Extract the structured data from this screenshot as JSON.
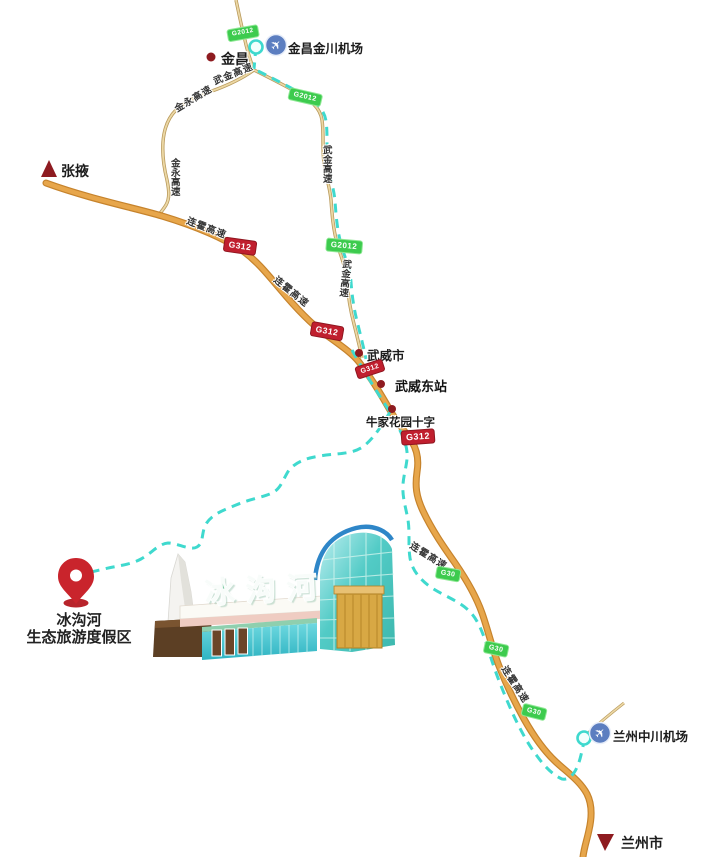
{
  "type": "route-map",
  "places": {
    "jinchang": "金昌",
    "jinchang_airport": "金昌金川机场",
    "zhangye": "张掖",
    "wuwei_city": "武威市",
    "wuwei_east_station": "武威东站",
    "niujia_crossing": "牛家花园十字",
    "lanzhou_airport": "兰州中川机场",
    "lanzhou_city": "兰州市",
    "resort_name": "冰沟河",
    "resort_subtitle": "生态旅游度假区"
  },
  "road_labels": {
    "wujin_expressway": "武金高速",
    "jinyong_expressway": "金永高速",
    "lianhuo_expressway": "连霍高速"
  },
  "badges": {
    "g312": "G312",
    "g2012": "G2012",
    "g30": "G30"
  },
  "landmark": {
    "gate_sign": "冰沟河"
  },
  "glyphs": {
    "airplane": "✈"
  },
  "colors": {
    "road_main": "#e7a64b",
    "road_edge": "#c6832c",
    "road_thin": "#dcbd7f",
    "route_dash": "#3fd9ce",
    "badge_red": "#c01f2e",
    "badge_green": "#3dcb4e",
    "marker_dark_red": "#8e1b20",
    "pin_red": "#c9242c",
    "airport_blue": "#5c7ec0",
    "text_dark": "#1c1c1c"
  }
}
